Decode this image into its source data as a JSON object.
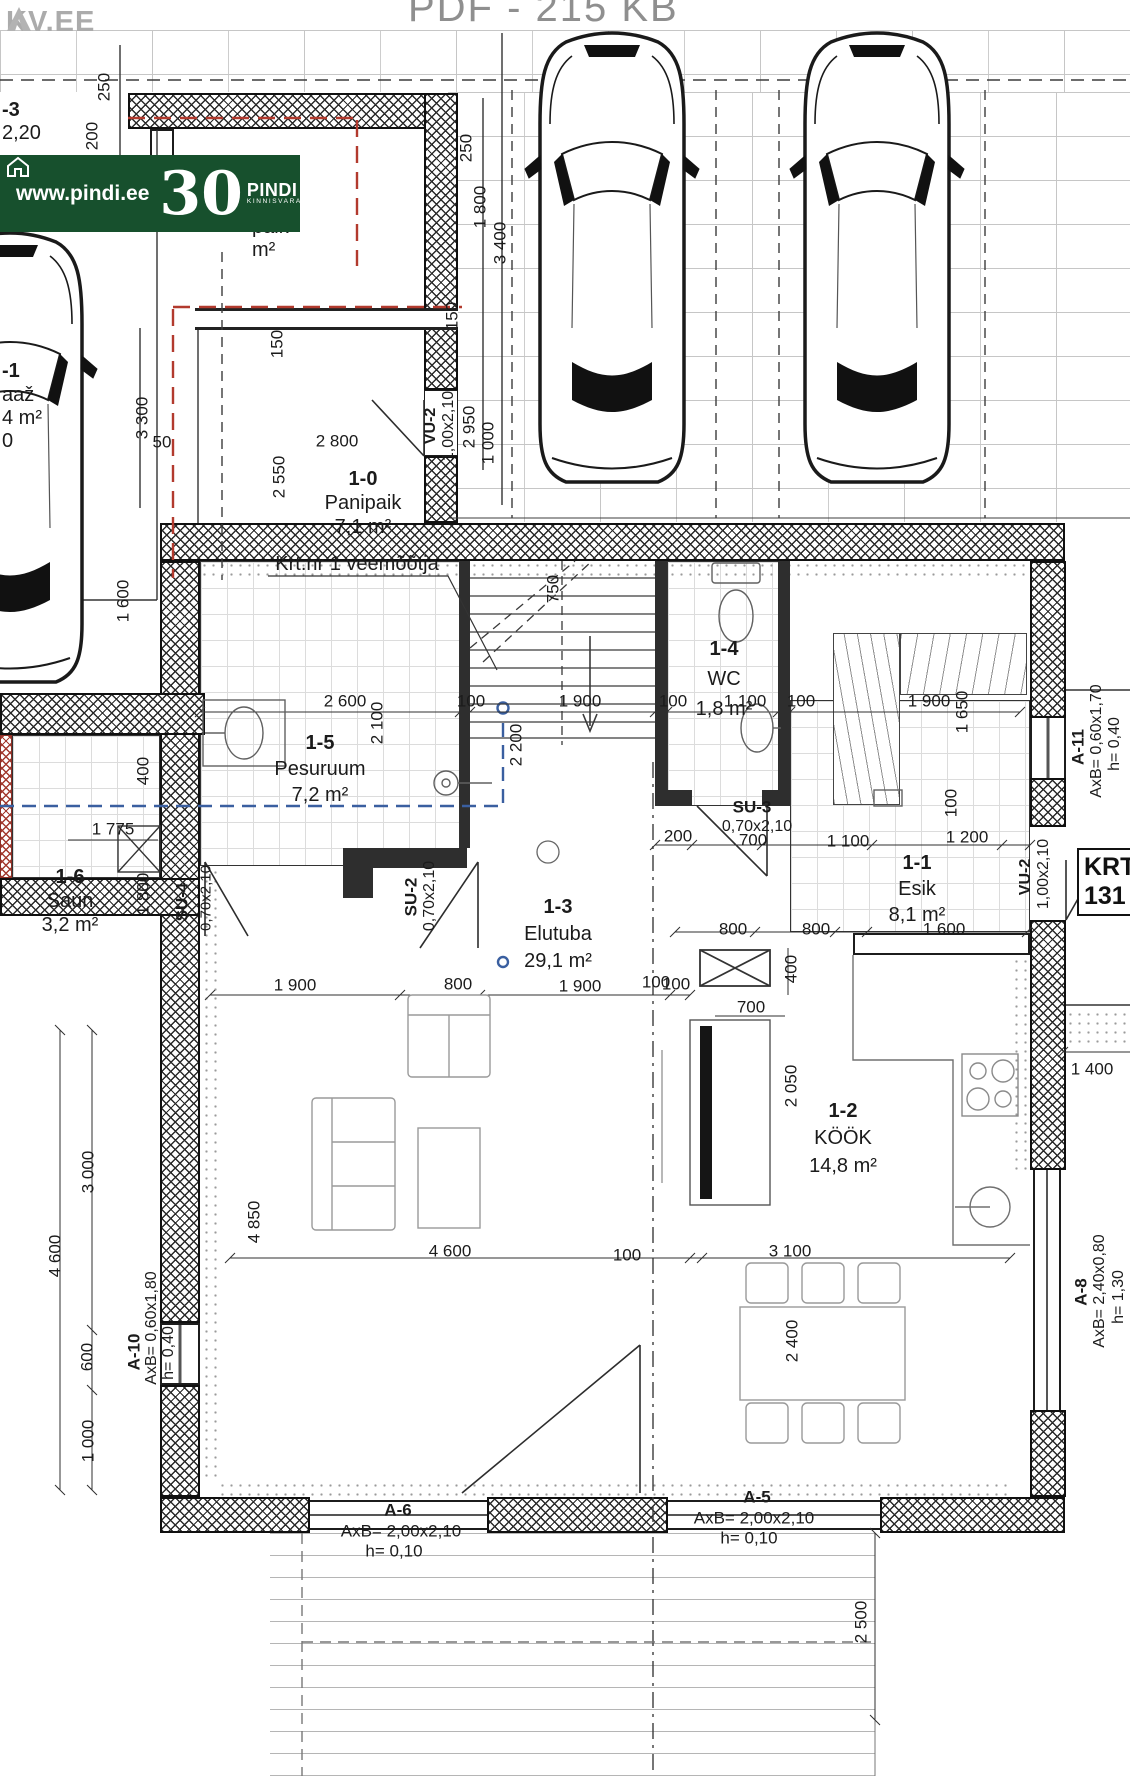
{
  "header": {
    "file_info": "PDF - 215 KB",
    "logo": "KV.EE"
  },
  "banner": {
    "url": "www.pindi.ee",
    "years": "30",
    "brand": "PINDI",
    "brand_sub": "KINNISVARA"
  },
  "annotation": {
    "water_meter": "Krt.nr 1 veemõõtja"
  },
  "krt_box": {
    "line1": "KRT",
    "line2": "131"
  },
  "rooms": [
    {
      "code": "1-0",
      "name": "Panipaik",
      "area": "7,1 m²"
    },
    {
      "code": "1-5",
      "name": "Pesuruum",
      "area": "7,2 m²"
    },
    {
      "code": "1-6",
      "name": "Saun",
      "area": "3,2 m²"
    },
    {
      "code": "1-4",
      "name": "WC",
      "area": "1,8 m²"
    },
    {
      "code": "1-1",
      "name": "Esik",
      "area": "8,1 m²"
    },
    {
      "code": "1-3",
      "name": "Elutuba",
      "area": "29,1 m²"
    },
    {
      "code": "1-2",
      "name": "KÖÖK",
      "area": "14,8 m²"
    }
  ],
  "fragments": {
    "door_code": "-3",
    "door_size": "2,20",
    "garage_code": "-1",
    "garage_name": "aaž",
    "garage_area": "4 m²",
    "garage_extra": "0",
    "storage_code": "0",
    "storage_name": "paik",
    "storage_area": "m²"
  },
  "doors": {
    "vu2": {
      "code": "VU-2",
      "size": "1,00x2,10"
    },
    "su2": {
      "code": "SU-2",
      "size": "0,70x2,10"
    },
    "su3": {
      "code": "SU-3",
      "size": "0,70x2,10"
    },
    "su4": {
      "code": "SU-4",
      "size": "0,70x2,10"
    },
    "a11": {
      "code": "A-11",
      "size": "AxB= 0,60x1,70",
      "h": "h= 0,40"
    },
    "a10": {
      "code": "A-10",
      "size": "AxB= 0,60x1,80",
      "h": "h= 0,40"
    },
    "a8": {
      "code": "A-8",
      "size": "AxB= 2,40x0,80",
      "h": "h= 1,30"
    },
    "a6": {
      "code": "A-6",
      "size": "AxB= 2,00x2,10",
      "h": "h= 0,10"
    },
    "a5": {
      "code": "A-5",
      "size": "AxB= 2,00x2,10",
      "h": "h= 0,10"
    }
  },
  "dims": {
    "t250a": "250",
    "t200": "200",
    "t250b": "250",
    "t1800": "1 800",
    "t3400": "3 400",
    "t150a": "150",
    "t150b": "150",
    "t3300": "3 300",
    "t50": "50",
    "t2800": "2 800",
    "t2550": "2 550",
    "t2950": "2 950",
    "t1000": "1 000",
    "t1600": "1 600",
    "r2600": "2 600",
    "r100a": "100",
    "r1900a": "1 900",
    "r100b": "100",
    "r1100a": "1 100",
    "r100c": "100",
    "r1900b": "1 900",
    "v2100": "2 100",
    "v2200": "2 200",
    "v750": "750",
    "v1650": "1 650",
    "v100": "100",
    "r200": "200",
    "r700": "700",
    "r1100b": "1 100",
    "r1200": "1 200",
    "e1600": "1 600",
    "k800a": "800",
    "k800b": "800",
    "k100": "100",
    "k400": "400",
    "k700": "700",
    "v2050": "2 050",
    "l1900a": "1 900",
    "l800": "800",
    "l1900b": "1 900",
    "l100": "100",
    "s1775": "1 775",
    "s1800": "1 800",
    "s400": "400",
    "L3000": "3 000",
    "L4600": "4 600",
    "L600": "600",
    "L1000": "1 000",
    "L4850": "4 850",
    "w4600": "4 600",
    "w100": "100",
    "w3100": "3 100",
    "w2400": "2 400",
    "w2500": "2 500",
    "w1400": "1 400"
  }
}
